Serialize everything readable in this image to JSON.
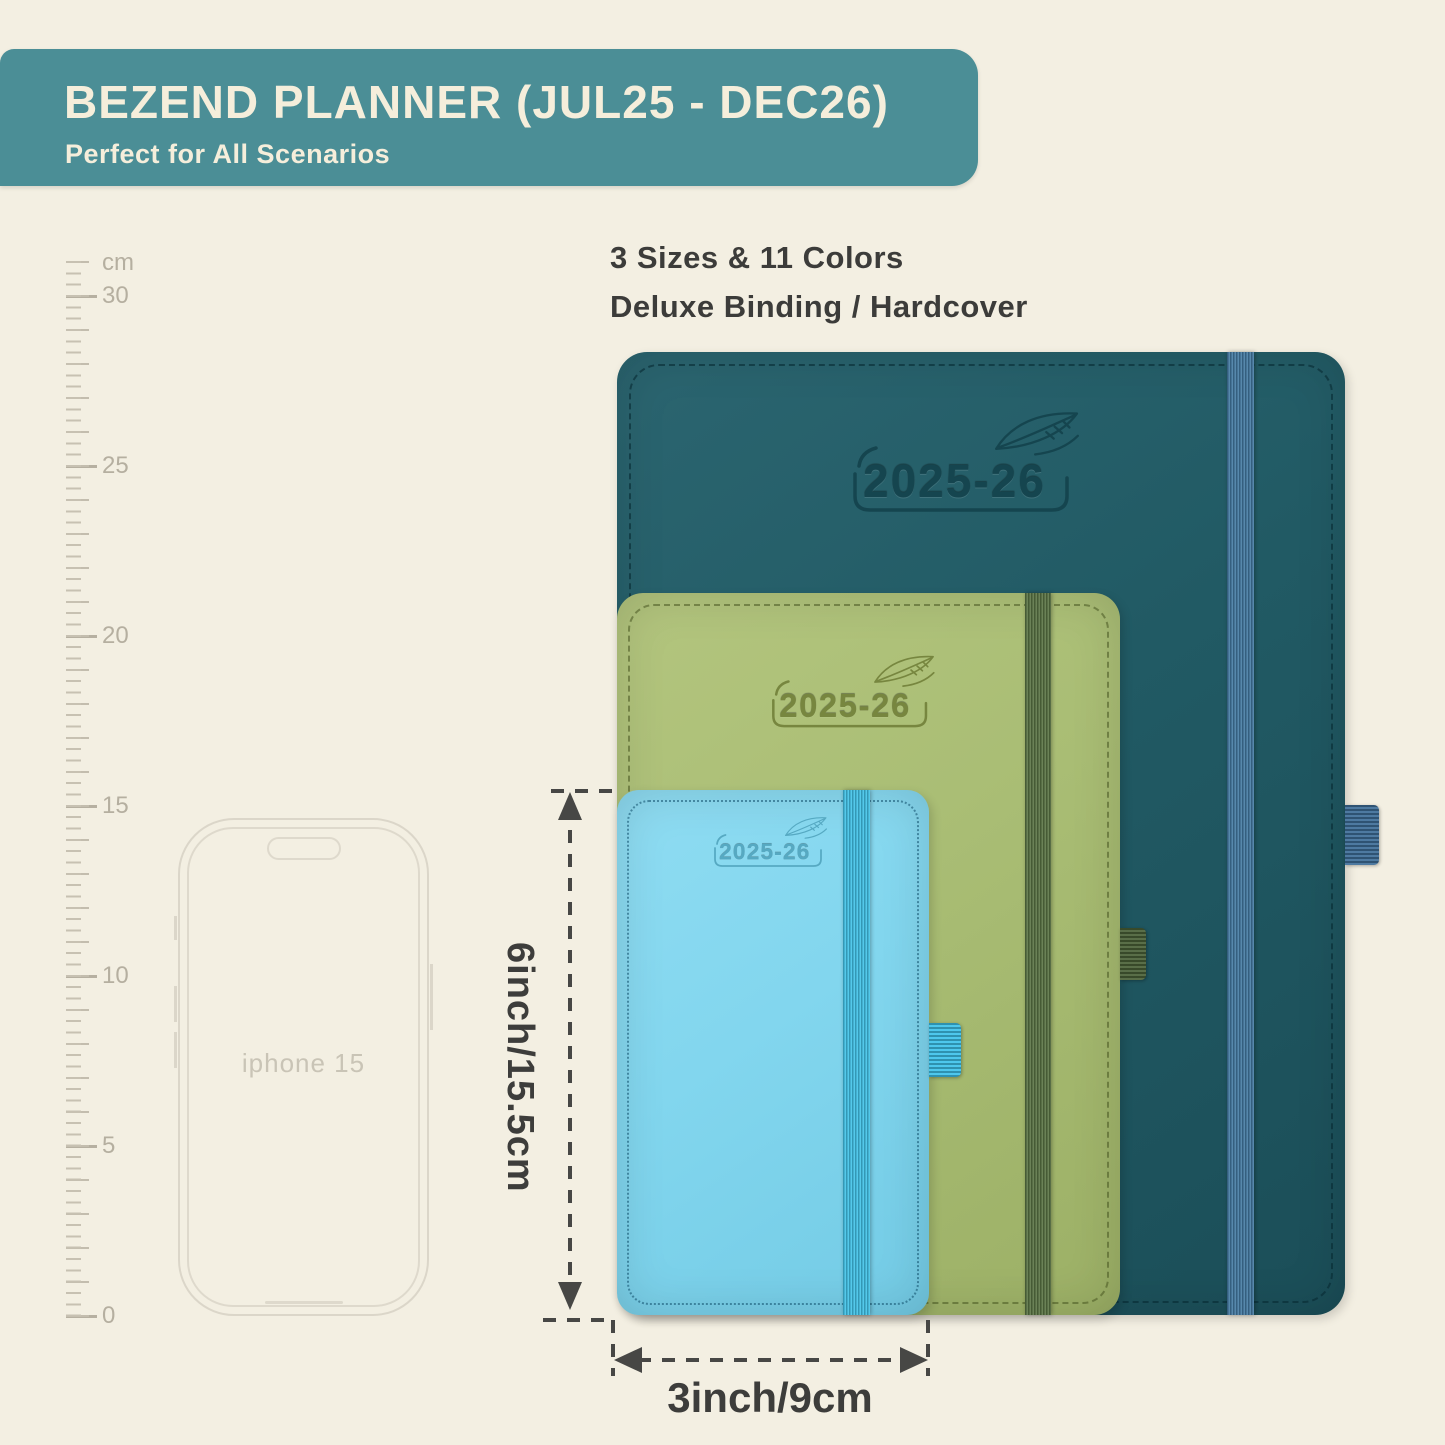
{
  "banner": {
    "title": "BEZEND PLANNER (JUL25 - DEC26)",
    "subtitle": "Perfect for All Scenarios",
    "bg_color": "#4b8e96",
    "text_color": "#f5eedb"
  },
  "headline": {
    "line1": "3 Sizes & 11 Colors",
    "line2": "Deluxe Binding / Hardcover"
  },
  "ruler": {
    "unit": "cm",
    "labels": [
      "30",
      "25",
      "20",
      "15",
      "10",
      "5",
      "0"
    ]
  },
  "phone": {
    "label": "iphone 15"
  },
  "planners": [
    {
      "name": "large",
      "year": "2025-26",
      "cover_color": "#215a64",
      "band_color": "#447aa3"
    },
    {
      "name": "medium",
      "year": "2025-26",
      "cover_color": "#a9bd74",
      "band_color": "#5a7444"
    },
    {
      "name": "small",
      "year": "2025-26",
      "cover_color": "#82d6ee",
      "band_color": "#41c3e8"
    }
  ],
  "measurements": {
    "height": "6inch/15.5cm",
    "width": "3inch/9cm"
  }
}
